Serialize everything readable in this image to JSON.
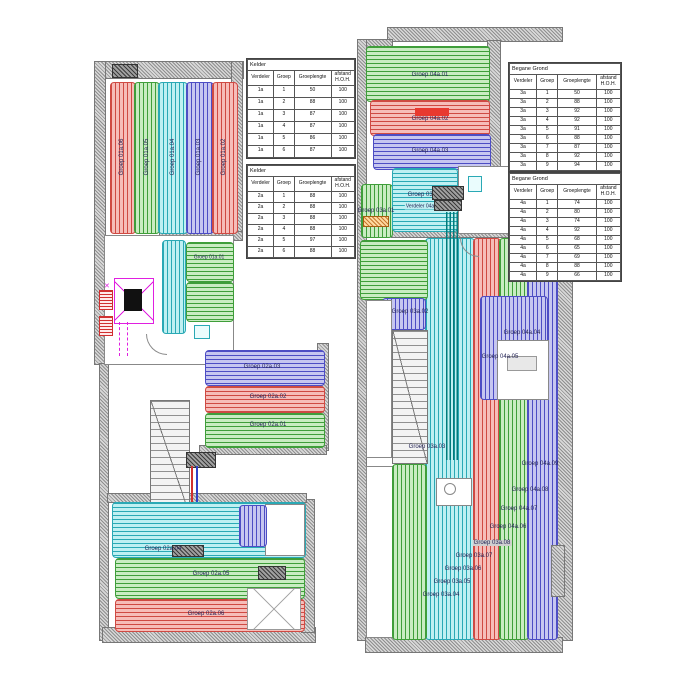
{
  "drawing": {
    "title": "Vloerverwarming legplan",
    "floors": [
      "Kelder",
      "Begane Grond"
    ]
  },
  "palette": {
    "loop_red": "#cf4a43",
    "loop_green": "#3f9e3a",
    "loop_cyan": "#2aa9b5",
    "loop_blue": "#4d4dc4",
    "wall_grey": "#8f8f8f",
    "lift_magenta": "#e01fe0",
    "supply_teal": "#007b7b",
    "highlight_red": "#e8392f",
    "highlight_grey": "#cfcfcf",
    "highlight_cyan": "#bfeef2",
    "label_text": "#232355"
  },
  "tables": [
    {
      "title": "Kelder",
      "headers": [
        "Verdeler",
        "Groep",
        "Groeplengte",
        "afstand|H.O.H."
      ],
      "row_h": 12,
      "rows": [
        [
          "1a",
          "1",
          "50",
          "100"
        ],
        [
          "1a",
          "2",
          "88",
          "100"
        ],
        [
          "1a",
          "3",
          "87",
          "100"
        ],
        [
          "1a",
          "4",
          "87",
          "100"
        ],
        [
          "1a",
          "5",
          "86",
          "100"
        ],
        [
          "1a",
          "6",
          "87",
          "100"
        ]
      ]
    },
    {
      "title": "Kelder",
      "headers": [
        "Verdeler",
        "Groep",
        "Groeplengte",
        "afstand|H.O.H."
      ],
      "row_h": 11,
      "rows": [
        [
          "2a",
          "1",
          "88",
          "100"
        ],
        [
          "2a",
          "2",
          "88",
          "100"
        ],
        [
          "2a",
          "3",
          "88",
          "100"
        ],
        [
          "2a",
          "4",
          "88",
          "100"
        ],
        [
          "2a",
          "5",
          "97",
          "100"
        ],
        [
          "2a",
          "6",
          "88",
          "100"
        ]
      ]
    },
    {
      "title": "Begane Grond",
      "headers": [
        "Verdeler",
        "Groep",
        "Groeplengte",
        "afstand|H.O.H."
      ],
      "row_h": 9,
      "rows": [
        [
          "3a",
          "1",
          "50",
          "100"
        ],
        [
          "3a",
          "2",
          "88",
          "100"
        ],
        [
          "3a",
          "3",
          "92",
          "100"
        ],
        [
          "3a",
          "4",
          "92",
          "100"
        ],
        [
          "3a",
          "5",
          "91",
          "100"
        ],
        [
          "3a",
          "6",
          "88",
          "100"
        ],
        [
          "3a",
          "7",
          "87",
          "100"
        ],
        [
          "3a",
          "8",
          "92",
          "100"
        ],
        [
          "3a",
          "9",
          "94",
          "100"
        ]
      ]
    },
    {
      "title": "Begane Grond",
      "headers": [
        "Verdeler",
        "Groep",
        "Groeplengte",
        "afstand|H.O.H."
      ],
      "row_h": 9,
      "rows": [
        [
          "4a",
          "1",
          "74",
          "100"
        ],
        [
          "4a",
          "2",
          "80",
          "100"
        ],
        [
          "4a",
          "3",
          "74",
          "100"
        ],
        [
          "4a",
          "4",
          "92",
          "100"
        ],
        [
          "4a",
          "5",
          "68",
          "100"
        ],
        [
          "4a",
          "6",
          "65",
          "100"
        ],
        [
          "4a",
          "7",
          "69",
          "100"
        ],
        [
          "4a",
          "8",
          "88",
          "100"
        ],
        [
          "4a",
          "9",
          "66",
          "100"
        ]
      ]
    }
  ],
  "plan_labels": [
    {
      "text": "Groep 01a.06",
      "x": 122,
      "y": 157,
      "vertical": true
    },
    {
      "text": "Groep 01a.05",
      "x": 147,
      "y": 157,
      "vertical": true
    },
    {
      "text": "Groep 01a.04",
      "x": 173,
      "y": 157,
      "vertical": true
    },
    {
      "text": "Groep 01a.03",
      "x": 199,
      "y": 157,
      "vertical": true
    },
    {
      "text": "Groep 01a.02",
      "x": 224,
      "y": 157,
      "vertical": true
    },
    {
      "text": "Groep 01a.01",
      "x": 209,
      "y": 258,
      "size": 5
    },
    {
      "text": "Groep 02a.03",
      "x": 262,
      "y": 367
    },
    {
      "text": "Groep 02a.02",
      "x": 268,
      "y": 397
    },
    {
      "text": "Groep 02a.01",
      "x": 268,
      "y": 425
    },
    {
      "text": "Groep 02a.04",
      "x": 163,
      "y": 549
    },
    {
      "text": "Groep 02a.05",
      "x": 211,
      "y": 574
    },
    {
      "text": "Groep 02a.06",
      "x": 206,
      "y": 614
    },
    {
      "text": "Groep 04a.01",
      "x": 430,
      "y": 75
    },
    {
      "text": "Groep 04a.02",
      "x": 430,
      "y": 119
    },
    {
      "text": "Groep 04a.03",
      "x": 430,
      "y": 151
    },
    {
      "text": "Groep 03a.01",
      "x": 376,
      "y": 211
    },
    {
      "text": "Groep 03a.09",
      "x": 426,
      "y": 195
    },
    {
      "text": "Verdeler 04a",
      "x": 420,
      "y": 207,
      "size": 5,
      "bg": "#bfeef2"
    },
    {
      "text": "Groep 03a.02",
      "x": 410,
      "y": 312
    },
    {
      "text": "Groep 03a.03",
      "x": 427,
      "y": 447
    },
    {
      "text": "Groep 04a.04",
      "x": 522,
      "y": 333
    },
    {
      "text": "Groep 04a.05",
      "x": 500,
      "y": 357
    },
    {
      "text": "Groep 04a.09",
      "x": 540,
      "y": 464
    },
    {
      "text": "Groep 04a.08",
      "x": 530,
      "y": 490
    },
    {
      "text": "Groep 04a.07",
      "x": 519,
      "y": 509
    },
    {
      "text": "Groep 04a.06",
      "x": 508,
      "y": 527
    },
    {
      "text": "Groep 03a.08",
      "x": 492,
      "y": 543,
      "bg": "#cfcfcf"
    },
    {
      "text": "Groep 03a.07",
      "x": 474,
      "y": 556
    },
    {
      "text": "Groep 03a.06",
      "x": 463,
      "y": 569
    },
    {
      "text": "Groep 03a.05",
      "x": 452,
      "y": 582
    },
    {
      "text": "Groep 03a.04",
      "x": 441,
      "y": 595
    }
  ]
}
